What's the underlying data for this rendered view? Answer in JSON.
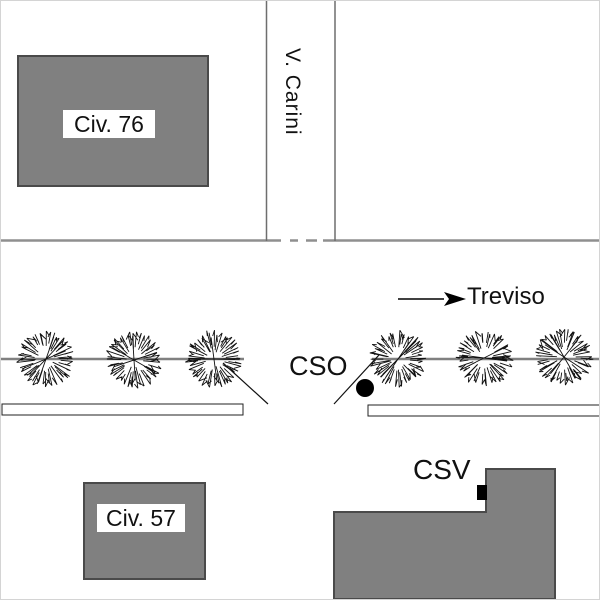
{
  "labels": {
    "building_76": "Civ. 76",
    "building_57": "Civ. 57",
    "street_vertical": "V. Carini",
    "survey_point_cso": "CSO",
    "survey_point_csv": "CSV",
    "direction_arrow": "Treviso"
  },
  "colors": {
    "background": "#ffffff",
    "building_fill": "#808080",
    "building_stroke": "#4a4a4a",
    "road_line": "#8f8f8f",
    "street_line": "#6e6e6e",
    "tree_line": "#808080",
    "ink": "#111111",
    "black": "#000000"
  },
  "map": {
    "canvas": {
      "width": 600,
      "height": 600
    },
    "roads": {
      "vertical_street_lines": [
        {
          "x": 265.5,
          "y1": 0,
          "y2": 240
        },
        {
          "x": 334.0,
          "y1": 0,
          "y2": 240
        }
      ],
      "horizontal_road_line": {
        "y": 239.5,
        "x1": 0,
        "x2": 600
      },
      "road_line_gaps": [
        [
          280,
          289
        ],
        [
          297,
          305
        ],
        [
          316,
          322
        ]
      ]
    },
    "tree_row": {
      "line_y": 358,
      "line_segments": [
        [
          0,
          243
        ],
        [
          371,
          600
        ]
      ],
      "radius": 28,
      "centers": [
        [
          45,
          358
        ],
        [
          133,
          359
        ],
        [
          213,
          358
        ],
        [
          397,
          358
        ],
        [
          483,
          357
        ],
        [
          563,
          356
        ]
      ]
    },
    "leader_lines": [
      {
        "x1": 222,
        "y1": 362,
        "x2": 267,
        "y2": 403
      },
      {
        "x1": 333,
        "y1": 403,
        "x2": 378,
        "y2": 354
      }
    ],
    "sidewalks": [
      {
        "x": 1,
        "y": 403,
        "w": 241,
        "h": 11
      },
      {
        "x": 367,
        "y": 404,
        "w": 235,
        "h": 11
      }
    ],
    "buildings": {
      "civ76": {
        "x": 17,
        "y": 55,
        "w": 190,
        "h": 130
      },
      "civ57": {
        "x": 83,
        "y": 482,
        "w": 121,
        "h": 96
      },
      "l_building": {
        "points": [
          [
            333,
            511
          ],
          [
            485,
            511
          ],
          [
            485,
            468
          ],
          [
            554,
            468
          ],
          [
            554,
            598
          ],
          [
            333,
            598
          ]
        ]
      }
    },
    "arrow": {
      "x1": 397,
      "y1": 298,
      "x2": 443,
      "y2": 298,
      "head": [
        [
          443,
          291
        ],
        [
          465,
          298
        ],
        [
          443,
          305
        ],
        [
          448,
          298
        ]
      ]
    },
    "survey_dot": {
      "cx": 364,
      "cy": 387,
      "r": 9
    },
    "door_marker": {
      "x": 476,
      "y": 484,
      "w": 10,
      "h": 15
    }
  }
}
